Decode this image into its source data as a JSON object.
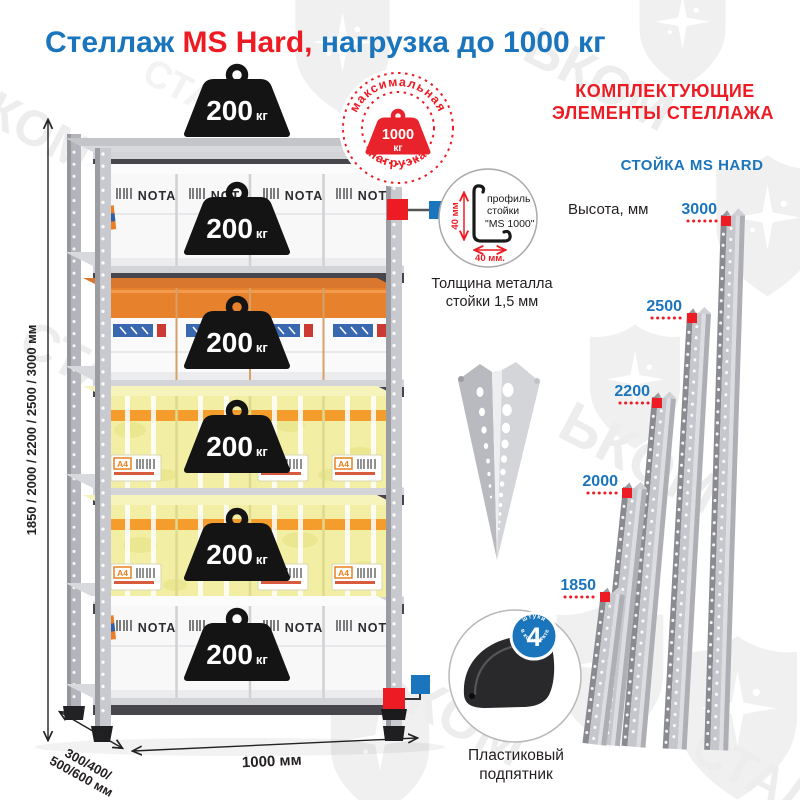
{
  "title": {
    "part1": "Стеллаж",
    "part2": " MS Hard,",
    "part3": " нагрузка до 1000 кг"
  },
  "watermark": {
    "word": "СТАЛЬКОМ",
    "fragments": {
      "f1": "КОМ",
      "f2": "ЬКОМ",
      "f3": "СТАЛ",
      "f4": "СТАЛЬКОМ",
      "f5": "СТА"
    }
  },
  "max_load_badge": {
    "arc_top": "максимальная",
    "arc_bottom": "нагрузка",
    "value": "1000",
    "unit": "кг"
  },
  "rack": {
    "shelf_weights": [
      {
        "value": "200",
        "unit": "кг"
      },
      {
        "value": "200",
        "unit": "кг"
      },
      {
        "value": "200",
        "unit": "кг"
      },
      {
        "value": "200",
        "unit": "кг"
      },
      {
        "value": "200",
        "unit": "кг"
      },
      {
        "value": "200",
        "unit": "кг"
      }
    ],
    "box_brand": "NOTA",
    "box_label": "A4",
    "dim_height": "1850 / 2000 / 2200 / 2500 / 3000 мм",
    "dim_depth_line1": "300/400/",
    "dim_depth_line2": "500/600 мм",
    "dim_width": "1000 мм"
  },
  "components": {
    "heading_line1": "КОМПЛЕКТУЮЩИЕ",
    "heading_line2": "ЭЛЕМЕНТЫ СТЕЛЛАЖА",
    "post": {
      "subheading": "СТОЙКА MS HARD",
      "height_label": "Высота, мм",
      "profile_line1": "профиль",
      "profile_line2": "стойки",
      "profile_line3": "\"MS 1000\"",
      "profile_dim_v": "40 мм",
      "profile_dim_h": "40 мм.",
      "thickness_line1": "Толщина металла",
      "thickness_line2": "стойки 1,5 мм",
      "heights": [
        "3000",
        "2500",
        "2200",
        "2000",
        "1850"
      ]
    },
    "foot": {
      "badge_value": "4",
      "badge_arc_top": "штуки",
      "badge_arc_bottom": "в комплекте",
      "caption_line1": "Пластиковый",
      "caption_line2": "подпятник"
    }
  },
  "colors": {
    "blue": "#1b75bc",
    "red": "#ed1c24",
    "metal": "#c6c7cc",
    "weight_black": "#141414"
  }
}
